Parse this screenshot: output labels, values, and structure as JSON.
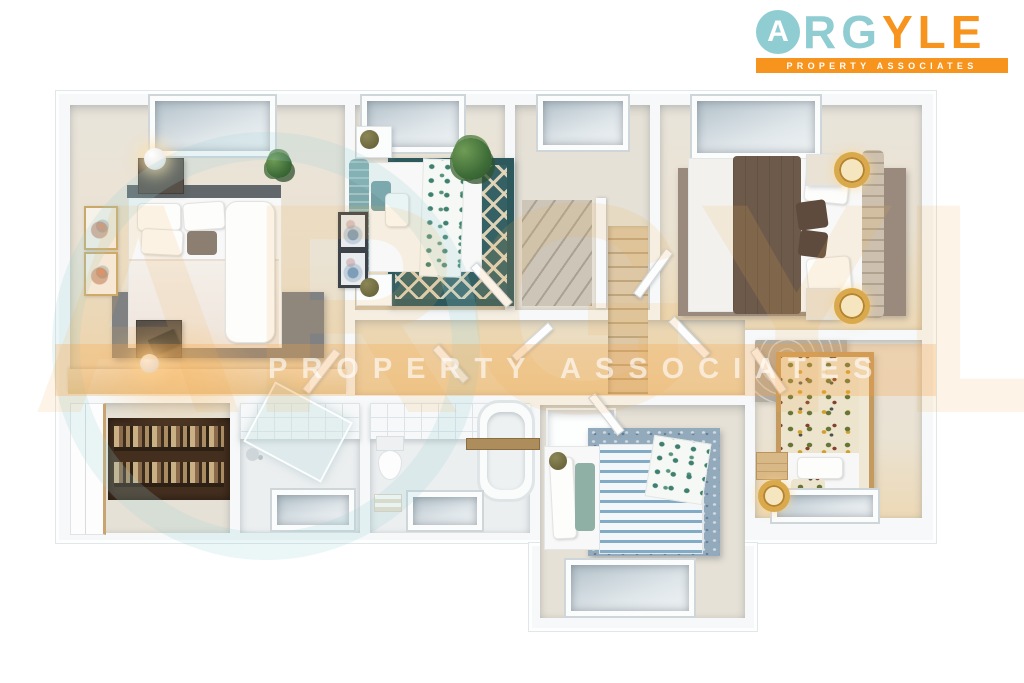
{
  "brand": {
    "monogram": "A",
    "name_teal": "RG",
    "name_orange": "YLE",
    "tagline": "PROPERTY ASSOCIATES",
    "colors": {
      "teal": "#8fcdd2",
      "orange": "#f7941e"
    }
  },
  "watermark": {
    "brand": "ARGYLE",
    "tagline": "PROPERTY ASSOCIATES"
  },
  "floorplan": {
    "view": "3D top-down dollhouse render of an upper floor, no text labels",
    "hallway": "L-shaped beige-carpeted landing connecting all rooms",
    "rooms": [
      {
        "id": "master-bedroom",
        "position": "top-left",
        "contents": "double bed with white bedding and dark headboard, grey rug, two dark nightstands with glowing sphere lamps, desk lamp, two gold-framed artworks, desk counter, roof window"
      },
      {
        "id": "bedroom-teal",
        "position": "top-centre-left",
        "contents": "double bed with teal headboard and botanical throw, dark-teal geometric rug, palm plant, two white nightstands with olive sphere lamps, two dark-framed artworks, roof window"
      },
      {
        "id": "stair-hall",
        "position": "top-centre",
        "contents": "U-shaped staircase with winder treads and beige carpeted lower flight, roof window"
      },
      {
        "id": "bedroom-brown",
        "position": "top-right",
        "contents": "double bed with brown duvet, ribbed beige headboard, two nightstands with gold drum lamps, taupe rug, roof window"
      },
      {
        "id": "study-closet",
        "position": "bottom-left",
        "contents": "dark wood shelving filled with books and papers, white wardrobe doors"
      },
      {
        "id": "shower-room",
        "position": "bottom-left-centre",
        "contents": "walk-in shower with angled glass screen, tiled wall, shower head, roof window"
      },
      {
        "id": "bathroom",
        "position": "bottom-centre",
        "contents": "freestanding bath with wooden caddy, toilet, towel stack, tiled wall, roof window"
      },
      {
        "id": "bedroom-blue",
        "position": "bottom-centre-right",
        "contents": "bed with blue striped duvet, sage and white pillows, leafy throw, wall niche with olive sphere lamp, mottled blue rug, roof window"
      },
      {
        "id": "bedroom-floral",
        "position": "bottom-right",
        "contents": "wood-framed single bed with floral duvet, crate nightstand, gold crescent lamp, patterned wallpaper, roof window"
      }
    ]
  }
}
